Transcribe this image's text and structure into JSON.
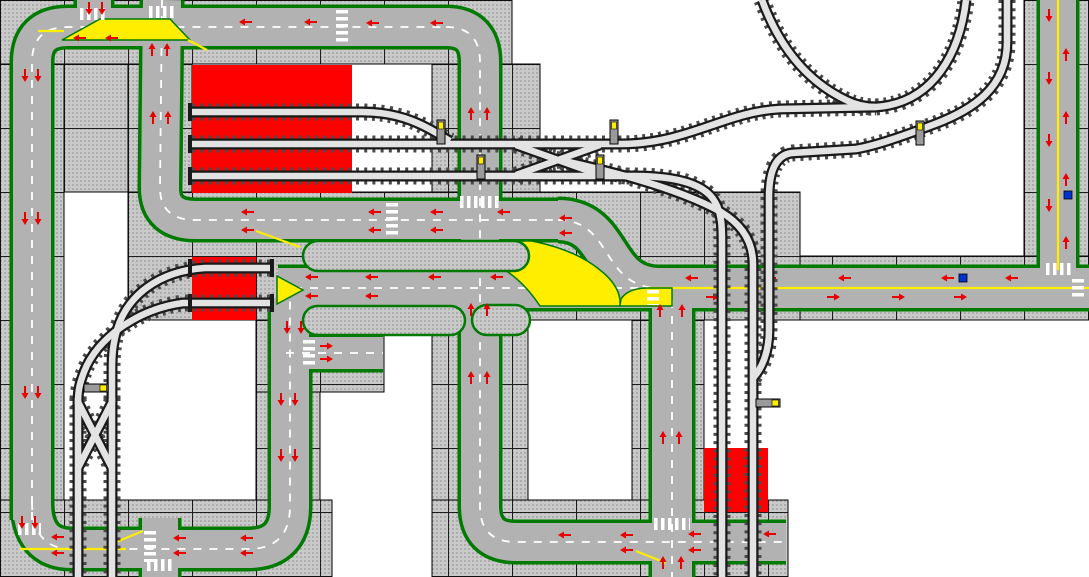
{
  "app": {
    "view_label": "track-layout-canvas",
    "zoom_percent": 100
  },
  "canvas": {
    "width": 1089,
    "height": 577,
    "tile_size": 64,
    "cols": 17,
    "rows": 9
  },
  "colors": {
    "background": "#ffffff",
    "plate_base": "#c9c9c9",
    "plate_dot": "#979797",
    "road_gray": "#b2b2b2",
    "road_edge_green": "#007a00",
    "line_white": "#ffffff",
    "line_yellow": "#ffee00",
    "platform_red": "#ff0000",
    "arrow_red": "#e60000",
    "rail_dark": "#1a1a1a",
    "rail_tie": "#4a4a4a",
    "rail_light": "#e3e3e3",
    "signal_yellow": "#ffee00",
    "signal_post": "#9a9a9a",
    "marker_blue": "#0033cc",
    "grid_line": "#000000"
  },
  "layout": {
    "baseplates": [
      [
        0,
        0,
        512,
        64
      ],
      [
        0,
        64,
        64,
        513
      ],
      [
        64,
        64,
        64,
        128
      ],
      [
        128,
        64,
        64,
        128
      ],
      [
        432,
        64,
        108,
        128
      ],
      [
        128,
        192,
        672,
        128
      ],
      [
        800,
        256,
        289,
        64
      ],
      [
        1024,
        0,
        65,
        256
      ],
      [
        256,
        320,
        128,
        72
      ],
      [
        256,
        392,
        64,
        116
      ],
      [
        432,
        320,
        96,
        185
      ],
      [
        632,
        320,
        72,
        185
      ],
      [
        0,
        500,
        332,
        77
      ],
      [
        432,
        500,
        356,
        77
      ]
    ],
    "red_platforms": [
      [
        192,
        65,
        160,
        128
      ],
      [
        192,
        257,
        64,
        63
      ],
      [
        704,
        448,
        64,
        64
      ]
    ],
    "roads": [
      {
        "d": "M 32,520 L 32,62 Q 32,27 68,27 L 450,27",
        "w": 38,
        "m": "dw"
      },
      {
        "d": "M 446,27 Q 480,27 480,62 L 480,506 Q 480,542 516,542 L 786,542",
        "w": 38,
        "m": "dw"
      },
      {
        "d": "M 32,502 Q 32,549 72,549 L 248,549 Q 290,549 290,506 L 290,298",
        "w": 38,
        "m": "dw"
      },
      {
        "d": "M 160,518 L 160,577",
        "w": 36,
        "m": "none"
      },
      {
        "d": "M 162,0 L 160,188 Q 160,220 196,220 L 562,220",
        "w": 38,
        "m": "dw"
      },
      {
        "d": "M 94,0 L 94,46",
        "w": 34,
        "m": "none"
      },
      {
        "d": "M 558,220 C 614,220 600,288 660,288",
        "w": 40,
        "m": "dw"
      },
      {
        "d": "M 278,288 L 652,288",
        "w": 40,
        "m": "dw"
      },
      {
        "d": "M 648,288 L 1089,288",
        "w": 40,
        "m": "sy"
      },
      {
        "d": "M 286,353 L 383,353",
        "w": 32,
        "m": "dw"
      },
      {
        "d": "M 672,300 L 672,577",
        "w": 40,
        "m": "dw"
      },
      {
        "d": "M 1058,0 L 1058,270",
        "w": 36,
        "m": "sy"
      }
    ],
    "yellow_fills": [
      "M 100,19 L 170,19 L 190,40 L 62,40 Z",
      "M 277,276 L 277,304 L 303,290 Z",
      "M 478,241 L 532,241 Q 576,250 600,270 Q 618,284 620,300 L 620,306 L 540,306 Q 520,276 494,264 L 478,260 Z",
      "M 648,288 Q 628,288 621,299 L 620,306 L 672,306 L 672,288 Z"
    ],
    "yellow_lines": [
      "M 38,31 L 64,31",
      "M 188,40 L 207,50",
      "M 256,231 L 300,247",
      "M 20,549 L 126,549",
      "M 104,547 L 143,531",
      "M 636,551 L 666,563"
    ],
    "median_islands": [
      [
        303,
        241,
        226,
        30
      ],
      [
        303,
        306,
        162,
        29
      ],
      [
        472,
        305,
        58,
        30
      ]
    ],
    "crosswalks": [
      "M 80,14 L 108,14",
      "M 149,12 L 176,12",
      "M 342,10 L 342,44",
      "M 460,202 L 500,202",
      "M 392,203 L 392,237",
      "M 309,340 L 309,366",
      "M 653,290 L 653,305",
      "M 654,524 L 690,524",
      "M 150,531 L 150,562",
      "M 147,565 L 173,565",
      "M 18,529 L 41,529",
      "M 1046,269 L 1072,269",
      "M 1078,279 L 1078,300"
    ],
    "traffic_arrows": [
      [
        89,
        8,
        "d"
      ],
      [
        102,
        8,
        "d"
      ],
      [
        152,
        50,
        "u"
      ],
      [
        167,
        50,
        "u"
      ],
      [
        246,
        22,
        "l"
      ],
      [
        311,
        22,
        "l"
      ],
      [
        373,
        23,
        "l"
      ],
      [
        437,
        23,
        "l"
      ],
      [
        80,
        38,
        "l"
      ],
      [
        112,
        38,
        "l"
      ],
      [
        25,
        75,
        "d"
      ],
      [
        38,
        75,
        "d"
      ],
      [
        25,
        218,
        "d"
      ],
      [
        38,
        218,
        "d"
      ],
      [
        25,
        392,
        "d"
      ],
      [
        38,
        392,
        "d"
      ],
      [
        22,
        522,
        "d"
      ],
      [
        35,
        522,
        "d"
      ],
      [
        153,
        118,
        "u"
      ],
      [
        168,
        118,
        "u"
      ],
      [
        248,
        212,
        "l"
      ],
      [
        375,
        212,
        "l"
      ],
      [
        437,
        212,
        "l"
      ],
      [
        504,
        212,
        "l"
      ],
      [
        248,
        230,
        "l"
      ],
      [
        375,
        230,
        "l"
      ],
      [
        437,
        230,
        "l"
      ],
      [
        566,
        218,
        "l"
      ],
      [
        566,
        233,
        "l"
      ],
      [
        312,
        277,
        "l"
      ],
      [
        372,
        277,
        "l"
      ],
      [
        435,
        277,
        "l"
      ],
      [
        497,
        277,
        "l"
      ],
      [
        312,
        296,
        "l"
      ],
      [
        372,
        296,
        "l"
      ],
      [
        326,
        346,
        "r"
      ],
      [
        326,
        359,
        "r"
      ],
      [
        287,
        327,
        "d"
      ],
      [
        301,
        327,
        "d"
      ],
      [
        281,
        399,
        "d"
      ],
      [
        295,
        399,
        "d"
      ],
      [
        281,
        455,
        "d"
      ],
      [
        295,
        455,
        "d"
      ],
      [
        471,
        114,
        "u"
      ],
      [
        487,
        114,
        "u"
      ],
      [
        471,
        310,
        "u"
      ],
      [
        487,
        310,
        "u"
      ],
      [
        471,
        378,
        "u"
      ],
      [
        487,
        378,
        "u"
      ],
      [
        58,
        537,
        "l"
      ],
      [
        58,
        553,
        "l"
      ],
      [
        180,
        538,
        "l"
      ],
      [
        247,
        538,
        "l"
      ],
      [
        180,
        553,
        "l"
      ],
      [
        247,
        553,
        "l"
      ],
      [
        565,
        535,
        "l"
      ],
      [
        627,
        535,
        "l"
      ],
      [
        695,
        534,
        "l"
      ],
      [
        770,
        534,
        "l"
      ],
      [
        627,
        550,
        "l"
      ],
      [
        695,
        550,
        "l"
      ],
      [
        663,
        438,
        "u"
      ],
      [
        679,
        438,
        "u"
      ],
      [
        660,
        311,
        "u"
      ],
      [
        682,
        311,
        "u"
      ],
      [
        663,
        563,
        "u"
      ],
      [
        681,
        563,
        "u"
      ],
      [
        692,
        278,
        "l"
      ],
      [
        770,
        278,
        "l"
      ],
      [
        845,
        278,
        "l"
      ],
      [
        948,
        278,
        "l"
      ],
      [
        1012,
        278,
        "l"
      ],
      [
        712,
        297,
        "r"
      ],
      [
        833,
        297,
        "r"
      ],
      [
        898,
        297,
        "r"
      ],
      [
        960,
        297,
        "r"
      ],
      [
        1049,
        15,
        "d"
      ],
      [
        1049,
        78,
        "d"
      ],
      [
        1049,
        140,
        "d"
      ],
      [
        1049,
        205,
        "d"
      ],
      [
        1066,
        55,
        "u"
      ],
      [
        1066,
        118,
        "u"
      ],
      [
        1066,
        180,
        "u"
      ],
      [
        1066,
        243,
        "u"
      ]
    ],
    "rail_tracks": [
      "M 192,112 L 362,112 C 405,112 428,128 450,141",
      "M 192,144 L 620,144 C 688,144 724,112 780,109 L 876,107 C 934,103 960,52 966,0",
      "M 192,176 L 633,176 C 682,176 706,186 715,202 C 722,214 722,228 722,244 L 722,577",
      "M 516,145 L 600,175",
      "M 516,175 L 600,145",
      "M 560,160 C 615,172 682,190 721,212 C 746,227 753,246 753,264 L 753,577",
      "M 1007,0 L 1007,42 C 1007,88 972,110 935,124 C 898,138 874,146 856,149 L 792,153 C 775,155 769,173 769,197 L 769,330 C 769,352 762,369 752,379",
      "M 762,0 C 773,30 796,76 846,100 C 856,105 866,107 876,107",
      "M 270,268 L 205,268 C 158,271 127,296 117,330 C 113,344 112,354 112,370 L 112,402",
      "M 270,303 L 183,303 C 138,309 97,338 84,372 C 79,385 78,392 78,404",
      "M 78,398 L 78,577",
      "M 112,398 L 112,577",
      "M 78,402 L 112,468",
      "M 112,402 L 78,468"
    ],
    "rail_end_caps": [
      [
        190,
        112
      ],
      [
        190,
        144
      ],
      [
        190,
        176
      ],
      [
        190,
        268
      ],
      [
        190,
        303
      ],
      [
        272,
        268
      ],
      [
        272,
        303
      ]
    ],
    "signals": [
      [
        437,
        120,
        "v"
      ],
      [
        610,
        120,
        "v"
      ],
      [
        477,
        155,
        "v"
      ],
      [
        596,
        155,
        "v"
      ],
      [
        916,
        121,
        "v"
      ],
      [
        84,
        384,
        "h"
      ],
      [
        756,
        399,
        "h"
      ]
    ],
    "blue_markers": [
      [
        959,
        274
      ],
      [
        1064,
        191
      ]
    ]
  }
}
